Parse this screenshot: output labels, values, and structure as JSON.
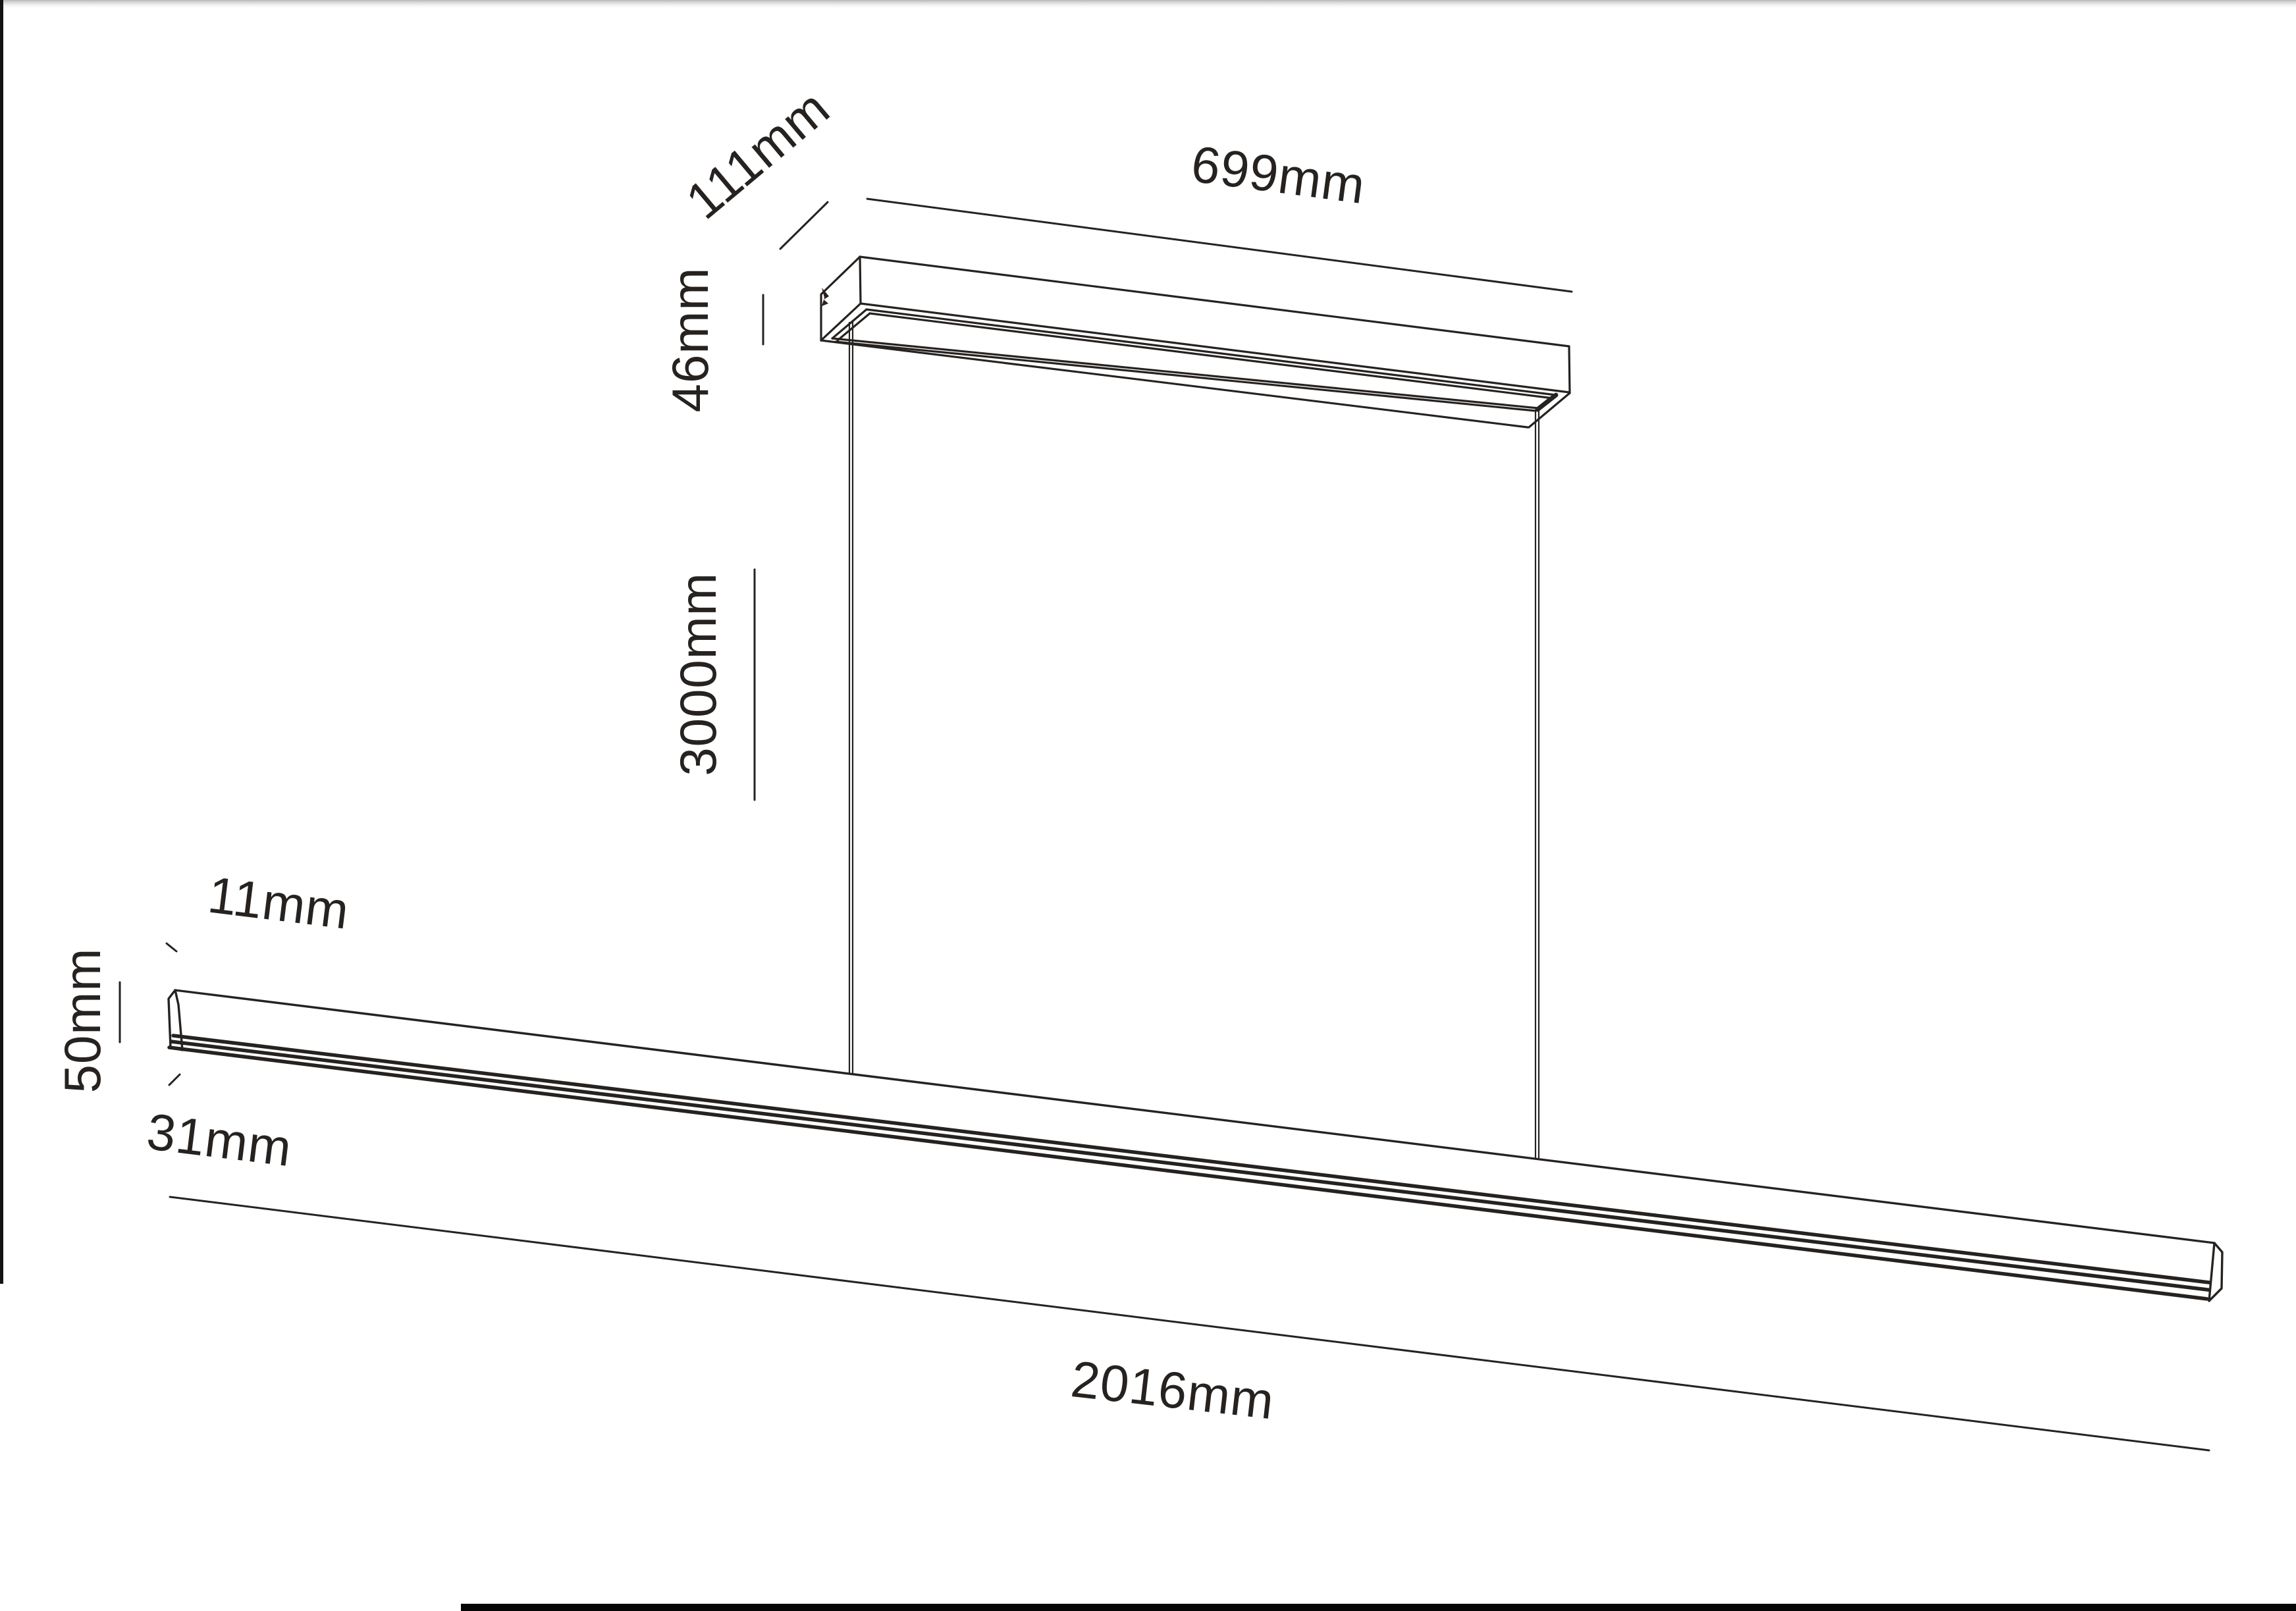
{
  "page": {
    "background": "#ffffff",
    "top_shadow_color": "#aaaaaa",
    "left_border_color": "#141414",
    "bottom_bar_color": "#060606",
    "line_color": "#262220"
  },
  "drawing": {
    "labels": {
      "canopy_depth": "111mm",
      "canopy_length": "699mm",
      "canopy_height": "46mm",
      "suspension_length": "3000mm",
      "bar_top_width": "11mm",
      "bar_height": "50mm",
      "bar_bottom_width": "31mm",
      "bar_length": "2016mm"
    }
  }
}
